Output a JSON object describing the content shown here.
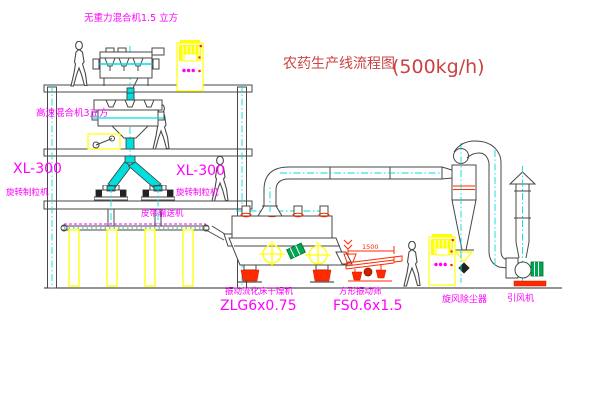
{
  "diagram": {
    "title": {
      "name": "农药生产线流程图",
      "capacity": "(500kg/h)"
    },
    "equipment_labels": {
      "gravity_free_mixer": "无重力混合机1.5 立方",
      "high_speed_mixer": "高速混合机3立方",
      "granulator_left_model": "XL-300",
      "granulator_left_name": "旋转制粒机",
      "granulator_center_model": "XL-300",
      "granulator_center_name": "旋转制粒机",
      "belt_conveyor": "皮带输送机",
      "fluid_bed_dryer_name": "振动流化床干燥机",
      "fluid_bed_dryer_model": "ZLG6x0.75",
      "square_sieve_name": "方形振动筛",
      "square_sieve_model": "FS0.6x1.5",
      "cyclone_collector": "旋风除尘器",
      "induced_draft_fan": "引风机"
    },
    "dimensions": {
      "sieve_length": "1500"
    },
    "colors": {
      "label_magenta": "#ff00ff",
      "title_red": "#cb4242",
      "cad_red": "#ff2a00",
      "cad_yellow": "#ffff00",
      "cad_cyan": "#00dede",
      "cad_green": "#00a650",
      "line_grey": "#474747",
      "background": "#ffffff"
    }
  }
}
